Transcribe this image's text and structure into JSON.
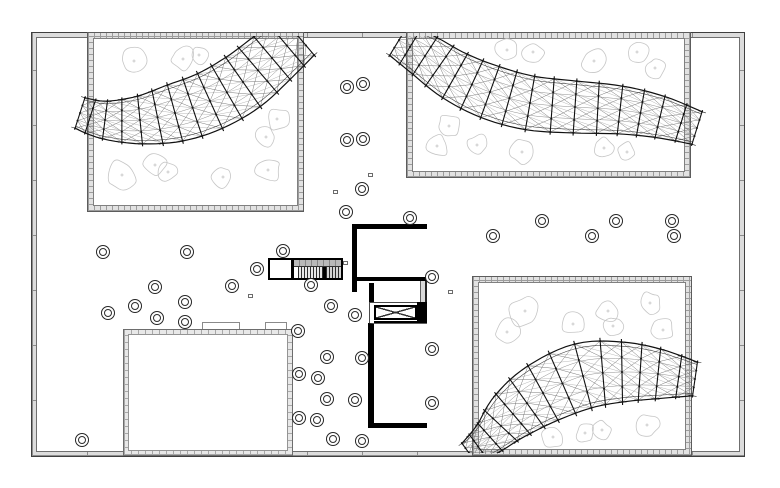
{
  "title": "architectural-site-plan",
  "canvas": {
    "width": 780,
    "height": 488,
    "background": "#ffffff"
  },
  "colors": {
    "ink": "#000000",
    "thin_line": "#4a4a4a",
    "wall_band": "#dcdcdc",
    "tree_outline": "#c6c6c6",
    "mesh_dark": "#101010",
    "mesh_mid": "#3a3a3a",
    "mesh_light": "#8f8f8f",
    "mesh_diag": "#6a6a6a"
  },
  "site": {
    "x": 32,
    "y": 33,
    "w": 712,
    "h": 423
  },
  "site_inner": {
    "x": 36,
    "y": 36,
    "w": 704,
    "h": 417
  },
  "courtyards": [
    {
      "id": "northwest",
      "x": 88,
      "y": 33,
      "w": 215,
      "h": 178
    },
    {
      "id": "northeast",
      "x": 407,
      "y": 33,
      "w": 283,
      "h": 144
    },
    {
      "id": "southeast",
      "x": 473,
      "y": 277,
      "w": 218,
      "h": 178
    }
  ],
  "pool": {
    "x": 124,
    "y": 330,
    "w": 168,
    "h": 125
  },
  "pool_tabs": [
    {
      "x": 202,
      "y": 322,
      "w": 38,
      "h": 9
    },
    {
      "x": 265,
      "y": 322,
      "w": 22,
      "h": 9
    }
  ],
  "stair": {
    "x": 268,
    "y": 258,
    "w": 75,
    "h": 22
  },
  "tower": {
    "top_room": {
      "x": 352,
      "y": 224,
      "w": 75,
      "h": 57
    },
    "right_band": {
      "x": 420,
      "y": 229,
      "w": 7,
      "h": 194
    },
    "stub_left": {
      "x": 352,
      "y": 279,
      "w": 5,
      "h": 13
    },
    "corridor_wall": {
      "x": 369,
      "y": 283,
      "w": 5,
      "h": 20
    },
    "elev_frame": {
      "x": 369,
      "y": 302,
      "w": 58,
      "h": 22
    },
    "elev_box": {
      "x": 374,
      "y": 305,
      "w": 43,
      "h": 15
    },
    "elev_block": {
      "x": 417,
      "y": 302,
      "w": 10,
      "h": 22
    },
    "elev_bar": {
      "x": 374,
      "y": 321,
      "w": 46,
      "h": 3
    },
    "bottom_room": {
      "x": 368,
      "y": 323,
      "w": 59,
      "h": 105
    }
  },
  "small_squares": [
    {
      "x": 343,
      "y": 261,
      "w": 5,
      "h": 4
    },
    {
      "x": 368,
      "y": 173,
      "w": 5,
      "h": 4
    },
    {
      "x": 333,
      "y": 190,
      "w": 5,
      "h": 4
    },
    {
      "x": 248,
      "y": 294,
      "w": 5,
      "h": 4
    },
    {
      "x": 448,
      "y": 290,
      "w": 5,
      "h": 4
    }
  ],
  "circles": [
    [
      103,
      252
    ],
    [
      187,
      252
    ],
    [
      283,
      251
    ],
    [
      257,
      269
    ],
    [
      155,
      287
    ],
    [
      232,
      286
    ],
    [
      135,
      306
    ],
    [
      108,
      313
    ],
    [
      157,
      318
    ],
    [
      185,
      302
    ],
    [
      185,
      322
    ],
    [
      82,
      440
    ],
    [
      311,
      285
    ],
    [
      298,
      331
    ],
    [
      327,
      357
    ],
    [
      362,
      358
    ],
    [
      299,
      374
    ],
    [
      318,
      378
    ],
    [
      327,
      399
    ],
    [
      355,
      400
    ],
    [
      299,
      418
    ],
    [
      317,
      420
    ],
    [
      333,
      439
    ],
    [
      362,
      441
    ],
    [
      347,
      87
    ],
    [
      363,
      84
    ],
    [
      347,
      140
    ],
    [
      363,
      139
    ],
    [
      362,
      189
    ],
    [
      346,
      212
    ],
    [
      410,
      218
    ],
    [
      331,
      306
    ],
    [
      355,
      315
    ],
    [
      432,
      277
    ],
    [
      432,
      349
    ],
    [
      432,
      403
    ],
    [
      493,
      236
    ],
    [
      542,
      221
    ],
    [
      592,
      236
    ],
    [
      616,
      221
    ],
    [
      672,
      221
    ],
    [
      674,
      236
    ]
  ],
  "trees": [
    [
      134,
      61,
      13,
      1
    ],
    [
      183,
      59,
      12,
      2
    ],
    [
      199,
      55,
      9,
      3
    ],
    [
      277,
      119,
      12,
      4
    ],
    [
      266,
      137,
      10,
      5
    ],
    [
      122,
      175,
      15,
      6
    ],
    [
      155,
      165,
      12,
      7
    ],
    [
      168,
      172,
      10,
      8
    ],
    [
      223,
      177,
      11,
      9
    ],
    [
      268,
      170,
      13,
      10
    ],
    [
      507,
      50,
      13,
      11
    ],
    [
      533,
      52,
      11,
      12
    ],
    [
      594,
      61,
      12,
      13
    ],
    [
      637,
      52,
      12,
      14
    ],
    [
      655,
      68,
      10,
      15
    ],
    [
      449,
      126,
      12,
      16
    ],
    [
      437,
      146,
      12,
      17
    ],
    [
      477,
      145,
      11,
      18
    ],
    [
      522,
      152,
      12,
      19
    ],
    [
      604,
      148,
      11,
      20
    ],
    [
      627,
      152,
      10,
      21
    ],
    [
      525,
      311,
      16,
      22
    ],
    [
      507,
      332,
      13,
      23
    ],
    [
      573,
      324,
      11,
      24
    ],
    [
      608,
      311,
      12,
      25
    ],
    [
      613,
      326,
      10,
      26
    ],
    [
      650,
      303,
      12,
      27
    ],
    [
      663,
      330,
      11,
      28
    ],
    [
      553,
      437,
      11,
      29
    ],
    [
      585,
      433,
      10,
      30
    ],
    [
      602,
      430,
      9,
      31
    ],
    [
      647,
      425,
      12,
      32
    ]
  ],
  "canopies": [
    {
      "id": "northwest-canopy",
      "points": [
        [
          80,
          113,
          16
        ],
        [
          105,
          120,
          19
        ],
        [
          140,
          120,
          24
        ],
        [
          175,
          113,
          29
        ],
        [
          210,
          101,
          30
        ],
        [
          243,
          82,
          30
        ],
        [
          272,
          58,
          28
        ],
        [
          298,
          36,
          25
        ]
      ]
    },
    {
      "id": "northeast-canopy",
      "points": [
        [
          399,
          40,
          18
        ],
        [
          425,
          56,
          22
        ],
        [
          455,
          76,
          25
        ],
        [
          490,
          92,
          27
        ],
        [
          530,
          103,
          27
        ],
        [
          575,
          107,
          26
        ],
        [
          620,
          110,
          24
        ],
        [
          660,
          117,
          21
        ],
        [
          697,
          128,
          17
        ]
      ]
    },
    {
      "id": "southeast-canopy",
      "points": [
        [
          469,
          453,
          12
        ],
        [
          490,
          437,
          18
        ],
        [
          513,
          414,
          26
        ],
        [
          543,
          393,
          31
        ],
        [
          583,
          376,
          33
        ],
        [
          622,
          372,
          30
        ],
        [
          658,
          374,
          25
        ],
        [
          695,
          379,
          17
        ]
      ]
    }
  ]
}
